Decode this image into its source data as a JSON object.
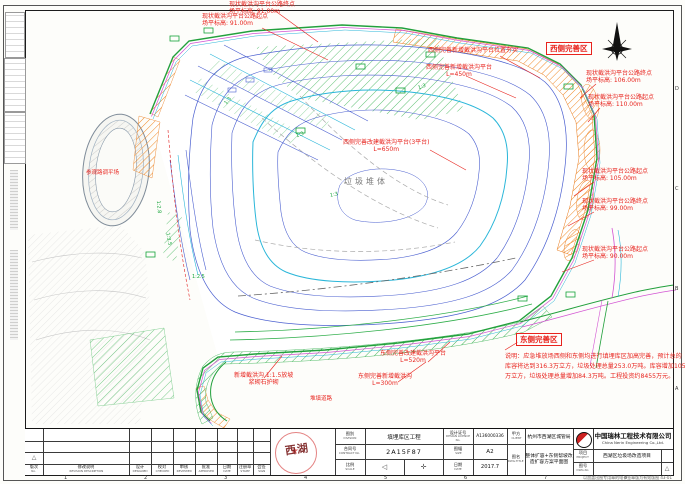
{
  "drawing": {
    "area_labels": {
      "west_zone": "西侧完善区",
      "east_zone": "东侧完善区",
      "waste_body": "垃圾堆体",
      "pond": "参观路调平场",
      "road": "堆填道路"
    },
    "slope_labels": [
      "1:3",
      "1:3",
      "1:3",
      "1:3",
      "1:2.5",
      "1:2.8",
      "1:3.5"
    ],
    "callouts": [
      {
        "line1": "现状截洪沟平台公路终点",
        "line2": "场平标高: 91.00m"
      },
      {
        "line1": "现状截洪沟平台公路起点",
        "line2": "场平标高: 91.00m"
      },
      {
        "line1": "现状截洪沟平台公路终点",
        "line2": "场平标高: 106.00m"
      },
      {
        "line1": "现状截洪沟平台公路起点",
        "line2": "场平标高: 110.00m"
      },
      {
        "line1": "现状截洪沟平台公路起点",
        "line2": "场平标高: 105.00m"
      },
      {
        "line1": "现状截洪沟平台公路终点",
        "line2": "场平标高: 99.00m"
      },
      {
        "line1": "现状截洪沟平台公路起点",
        "line2": "场平标高: 90.00m"
      },
      {
        "line1": "西侧完善新增截洪沟平台位置夯实",
        "line2": ""
      },
      {
        "line1": "西侧完善新增截洪沟平台",
        "line2": "L=450m"
      },
      {
        "line1": "西侧完善改建截洪沟平台(3平台)",
        "line2": "L=650m"
      },
      {
        "line1": "东侧完善改建截洪沟平台",
        "line2": "L=520m"
      },
      {
        "line1": "东侧完善新增截洪沟",
        "line2": "L=300m"
      },
      {
        "line1": "新增截洪沟 1:1.5放坡",
        "line2": "浆砌石护砌"
      }
    ],
    "notes": {
      "line1": "说明：应急堆放场西侧和东侧均进行填埋库区加高完善，预计总的",
      "line2": "库容将达到316.3万立方，垃圾处理总量253.0万吨。库容增加105.4",
      "line3": "万立方，垃圾处理总量增加84.3万吨。工程投资约8455万元。"
    },
    "colors": {
      "callout_red": "#e8231d",
      "contour_blue": "#4a5fd0",
      "contour_cyan": "#2ab6d9",
      "boundary_green": "#22a03c",
      "berm_orange": "#f08a28",
      "road_magenta": "#d355d3"
    }
  },
  "icons": {
    "north_arrow": "compass-star",
    "projection_left": "◁",
    "projection_right": "✛",
    "revision_triangle": "△",
    "dwg_triangle": "△"
  },
  "titleblock": {
    "division_label_cn": "图别",
    "division_label_en": "DIVISION",
    "division_value": "填埋库区工程",
    "contract_label_cn": "合同号",
    "contract_label_en": "CONTRACT No.",
    "contract_value": "2A15F87",
    "scale_label_cn": "比例",
    "scale_label_en": "SCALE",
    "licence_label_cn": "设计证号",
    "licence_label_en": "DESIGN LICENCE No.",
    "licence_value": "A136000336",
    "size_label_cn": "图幅",
    "size_label_en": "SIZE",
    "size_value": "A2",
    "date_label_cn": "日期",
    "date_label_en": "DATE",
    "date_value": "2017.7",
    "client_label_cn": "甲方",
    "client_label_en": "CLIENT",
    "client_value": "杭州市西湖区城管局",
    "dwgtitle_label_cn": "图名",
    "dwgtitle_label_en": "DWG.TITLE",
    "dwgtitle_value": "整体扩容+东侧帮坡改造扩容方案平面图",
    "company_cn": "中国瑞林工程技术有限公司",
    "company_en": "China Nerin Engineering Co.,Ltd.",
    "project_label_cn": "项目",
    "project_label_en": "PROJECT",
    "project_value": "西湖区垃圾场改造项目",
    "dwgno_label_cn": "图号",
    "dwgno_label_en": "DWG.No",
    "dwgno_value": "",
    "stamp_text": "西湖",
    "footer_note": "以加盖出图专用章的电子签章版为有效版图  43-01"
  },
  "revision_headers": [
    {
      "cn": "版次",
      "en": "No."
    },
    {
      "cn": "修改说明",
      "en": "REVISION DESCRIPTION"
    },
    {
      "cn": "设计",
      "en": "DESIGNED"
    },
    {
      "cn": "校对",
      "en": "CHECKED"
    },
    {
      "cn": "审核",
      "en": "REVIEWED"
    },
    {
      "cn": "批准",
      "en": "APPROVED"
    },
    {
      "cn": "日期",
      "en": "DATE"
    },
    {
      "cn": "注册章",
      "en": "STAMP"
    },
    {
      "cn": "会签",
      "en": "SIGN"
    }
  ],
  "frame": {
    "zone_numbers": [
      "1",
      "2",
      "3",
      "4",
      "5",
      "6",
      "7",
      "8"
    ],
    "zone_letters": [
      "D",
      "C",
      "B",
      "A"
    ]
  }
}
